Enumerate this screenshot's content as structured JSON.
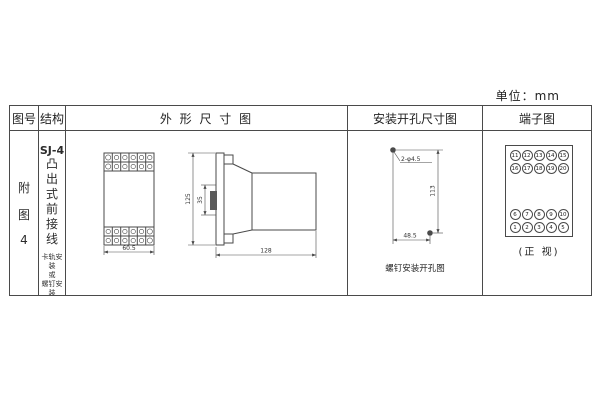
{
  "page": {
    "unit_label": "单位：mm"
  },
  "table": {
    "headers": {
      "figure_no": "图号",
      "structure": "结构",
      "outline": "外 形 尺 寸 图",
      "mounting": "安装开孔尺寸图",
      "terminal": "端子图"
    }
  },
  "figure_no": {
    "char1": "附",
    "char2": "图",
    "char3": "4"
  },
  "structure": {
    "model": "SJ-4",
    "type_chars": [
      "凸",
      "出",
      "式",
      "前",
      "接",
      "线"
    ],
    "note1": "卡轨安装",
    "note2": "或",
    "note3": "螺钉安装"
  },
  "outline": {
    "front_width": "60.5",
    "height": "125",
    "rail_width": "35",
    "depth": "128"
  },
  "mounting": {
    "hole_spec": "2-φ4.5",
    "vertical": "113",
    "horizontal": "48.5",
    "caption": "螺钉安装开孔图"
  },
  "terminal": {
    "caption": "(正 视)",
    "rows": {
      "t1": [
        "11",
        "12",
        "13",
        "14",
        "15"
      ],
      "t2": [
        "16",
        "17",
        "18",
        "19",
        "20"
      ],
      "b1": [
        "6",
        "7",
        "8",
        "9",
        "10"
      ],
      "b2": [
        "1",
        "2",
        "3",
        "4",
        "5"
      ]
    }
  }
}
